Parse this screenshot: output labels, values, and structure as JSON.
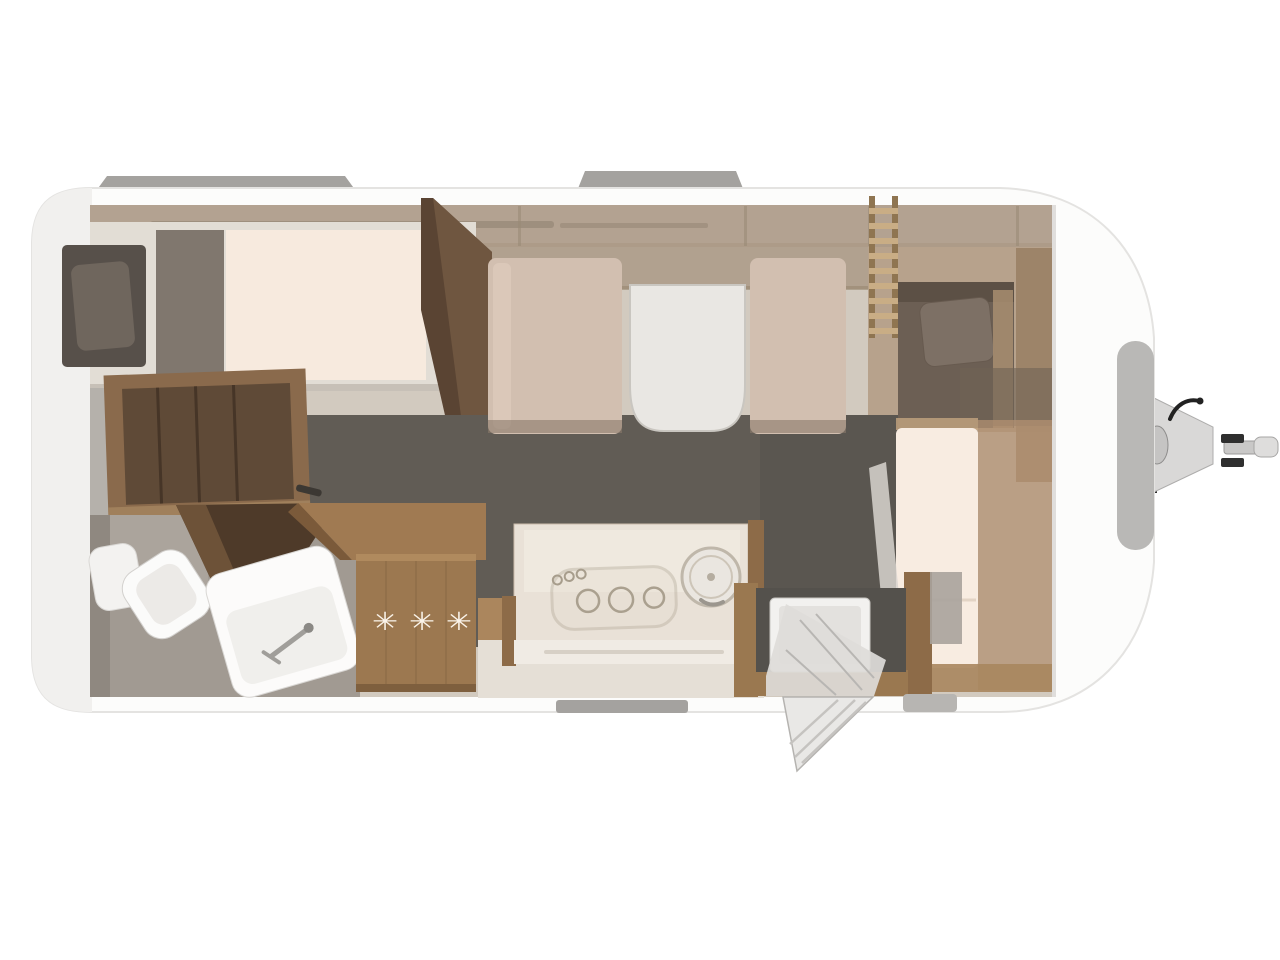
{
  "scene": {
    "description": "Top-down 3D rendered floor plan of a single-axle caravan, rear on the left, drawbar hitch on the right",
    "background": "#ffffff"
  },
  "fridge": {
    "freezer_stars": "✳ ✳ ✳"
  },
  "features": [
    "rear-longitudinal-bed-with-pillow",
    "foot-wardrobe",
    "open-wardrobe",
    "bathroom-with-toilet-and-washbasin",
    "open-bathroom-door",
    "kitchen-worktop",
    "three-burner-hob",
    "round-sink",
    "refrigerator-with-freezer-stars",
    "dinette-two-benches-and-table",
    "overhead-lockers",
    "bunk-bed-with-ladder",
    "front-bed",
    "entrance-door-open-with-step",
    "front-window",
    "roof-vents",
    "drawbar-hitch-with-jockey-wheel"
  ],
  "colors": {
    "shell": "#fcfcfb",
    "shell_shadow": "#f1f0ee",
    "interior_base": "#d2cabf",
    "wall_band": "#b3a291",
    "locker_band": "#ab9a86",
    "floor_dark": "#615c55",
    "bath_floor": "#a19a92",
    "wood": "#9c7850",
    "wood_dark": "#5a4433",
    "wood_mid": "#8a6a4c",
    "mattress_cream": "#f7eade",
    "pillow_dark": "#6f665d",
    "bunk_dark": "#6c5f54",
    "bench": "#d2bfb0",
    "table_white": "#e9e7e3",
    "fixture_white": "#fbfbfa",
    "vent_gray": "#a4a29f",
    "hitch_gray": "#d9d8d7",
    "star_cream": "#faf3e9"
  }
}
